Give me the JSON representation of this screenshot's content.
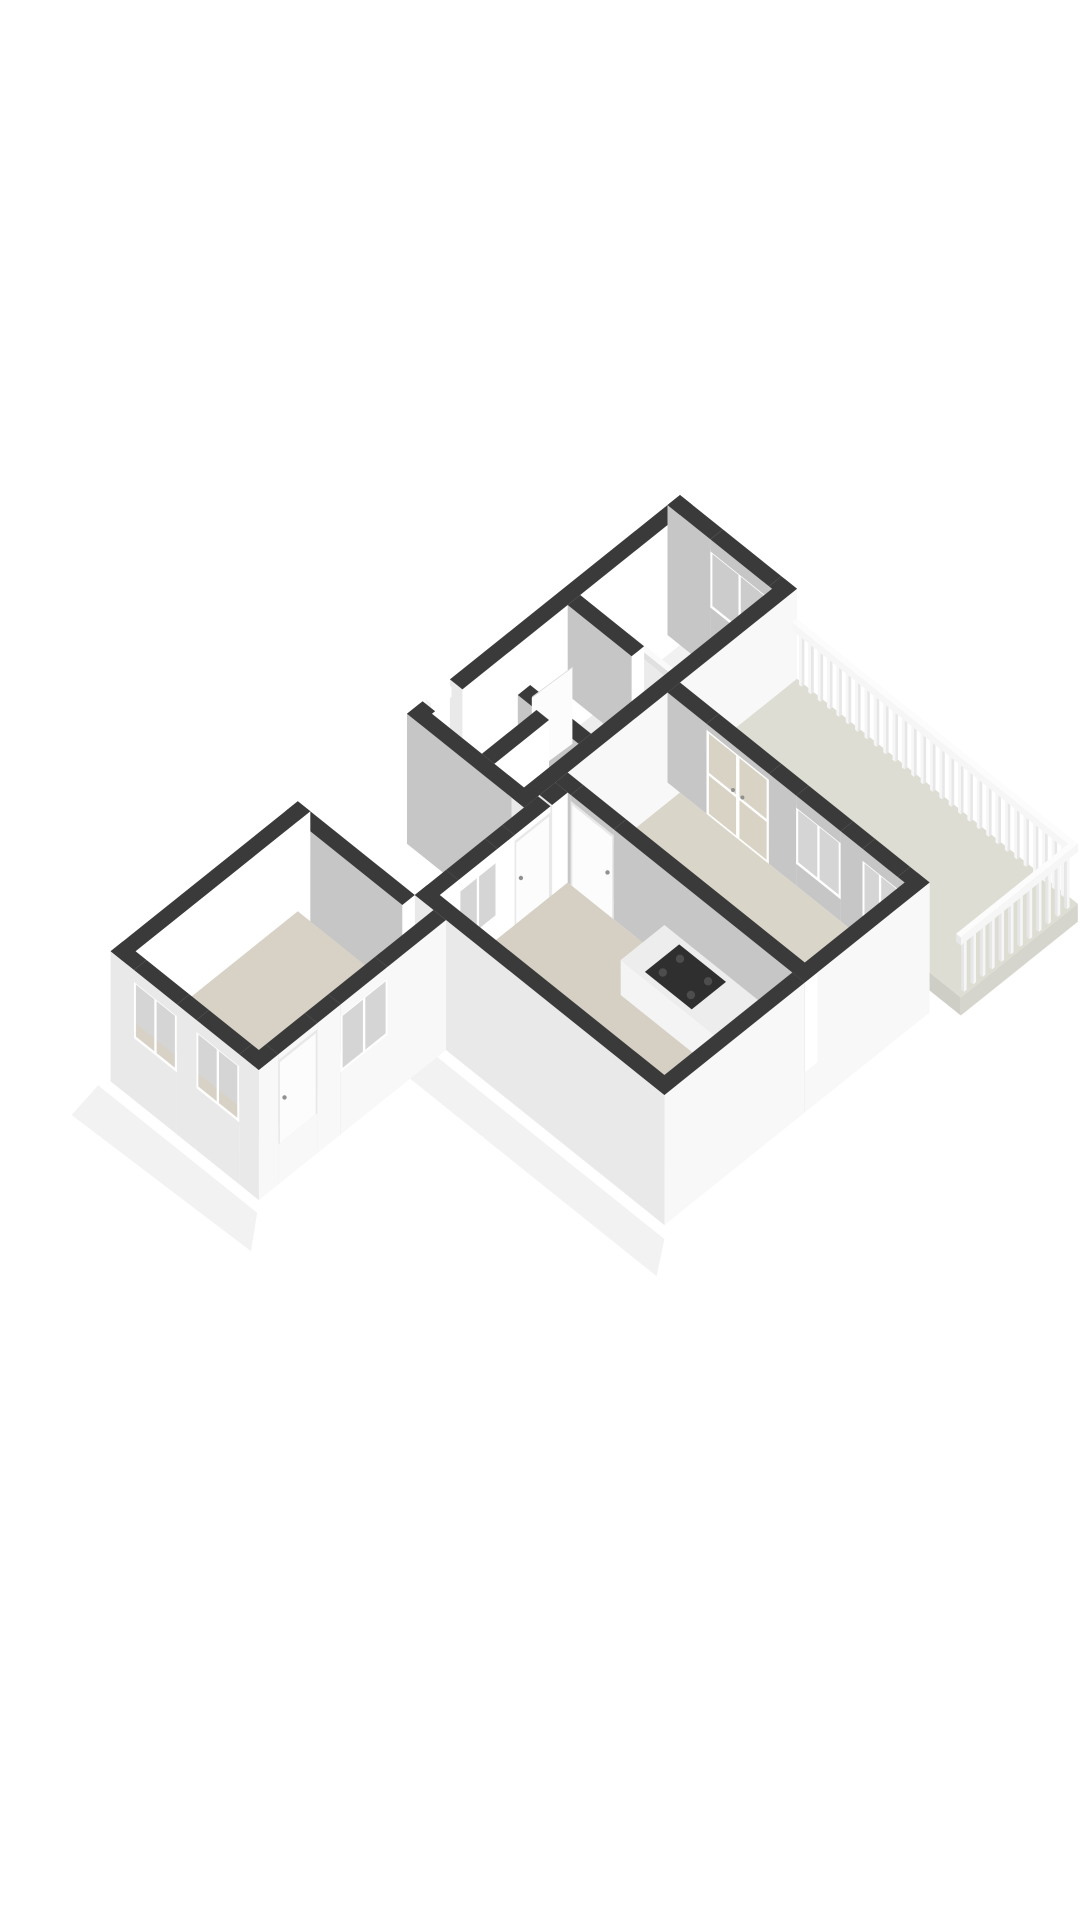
{
  "scene": {
    "type": "3d-floorplan-axonometric-render",
    "background": "#ffffff"
  },
  "colors": {
    "background": "#ffffff",
    "wall_top": "#3a3a3a",
    "wall_int_light": "#ffffff",
    "wall_int_shadow": "#c6c6c6",
    "wall_ext_bright": "#f8f8f8",
    "wall_ext_front": "#e9e9e9",
    "slab_edge": "#d8d8d8",
    "floor_white": "#f1f1f1",
    "floor_hall": "#ededed",
    "floor_living": "#d6d0c4",
    "floor_bedroom_right": "#dad5c9",
    "floor_bedroom_left": "#d8d2c6",
    "floor_balcony": "#deddd3",
    "glass": "#d5d5d5",
    "glass_dark": "#cccccc",
    "glass_french": "#d9d3c5",
    "frame_white": "#ffffff",
    "sill": "#fdfdfd",
    "tub_top": "#fafafa",
    "tub_inner": "#ebebeb",
    "tub_front": "#f3f3f3",
    "tub_side": "#efefef",
    "counter_top": "#ededed",
    "counter_front": "#f4f4f4",
    "counter_side": "#e3e3e3",
    "cooktop": "#2f2f2f",
    "burner": "#4d4d4d",
    "sink": "#f8f8f8",
    "sink_inner": "#e2e2e2",
    "faucet": "#cfcfcf",
    "railing": "#f6f6f6",
    "railing_shadow": "#e7e7e7",
    "railing_top": "#fcfcfc",
    "door_leaf": "#fcfcfc",
    "door_frame": "#e8e8e8",
    "handle": "#909090",
    "shadow": "rgba(0,0,0,0.05)"
  },
  "rooms": [
    {
      "name": "bathroom"
    },
    {
      "name": "hallway"
    },
    {
      "name": "toilet"
    },
    {
      "name": "living-room"
    },
    {
      "name": "kitchen"
    },
    {
      "name": "bedroom-right"
    },
    {
      "name": "bedroom-left"
    },
    {
      "name": "balcony"
    }
  ],
  "fixtures": [
    {
      "name": "bathtub"
    },
    {
      "name": "bathroom-window"
    },
    {
      "name": "entry-door"
    },
    {
      "name": "living-room-window"
    },
    {
      "name": "kitchen-counter"
    },
    {
      "name": "cooktop"
    },
    {
      "name": "kitchen-sink"
    },
    {
      "name": "french-doors"
    },
    {
      "name": "balcony-railing"
    },
    {
      "name": "bedroom-right-window",
      "count": 2
    },
    {
      "name": "bedroom-left-window",
      "count": 3
    },
    {
      "name": "bedroom-left-door"
    },
    {
      "name": "interior-door",
      "count": 3
    }
  ]
}
